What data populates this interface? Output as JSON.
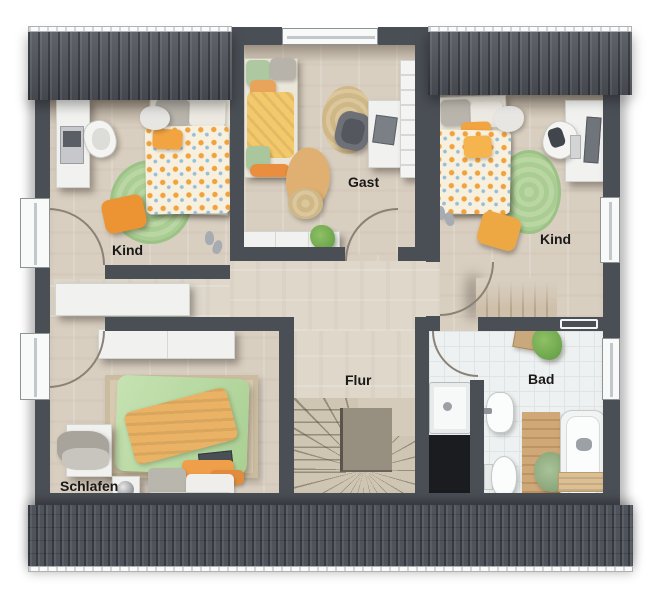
{
  "rooms": [
    {
      "id": "kind-left",
      "label": "Kind",
      "furniture": [
        "bed",
        "desk",
        "printer",
        "office-chair",
        "round-rug",
        "floor-cushion",
        "cloud-stool",
        "slippers",
        "window"
      ]
    },
    {
      "id": "gast",
      "label": "Gast",
      "furniture": [
        "daybed",
        "jute-rug",
        "armchair",
        "desk",
        "laptop",
        "wall-shelf",
        "sideboard",
        "plant",
        "throw-blanket",
        "pouf",
        "window"
      ]
    },
    {
      "id": "kind-right",
      "label": "Kind",
      "furniture": [
        "bed",
        "desk",
        "monitor",
        "office-chair",
        "round-rug",
        "floor-cushion",
        "cloud-stool",
        "slippers",
        "window"
      ]
    },
    {
      "id": "flur",
      "label": "Flur",
      "furniture": [
        "winder-staircase",
        "sideboard"
      ]
    },
    {
      "id": "bad",
      "label": "Bad",
      "furniture": [
        "shower",
        "washbasin",
        "toilet",
        "bathtub",
        "bath-caddy",
        "wooden-mat",
        "plant",
        "stool",
        "towel-radiator",
        "window"
      ]
    },
    {
      "id": "schlafen",
      "label": "Schlafen",
      "furniture": [
        "double-bed",
        "area-rug",
        "dresser",
        "clothes-pile",
        "nightstand",
        "table-lamp",
        "foot-bench",
        "sideboard",
        "window"
      ]
    }
  ],
  "colors": {
    "wall": "#4a4e55",
    "roof": "#4f535b",
    "floor_wood": "#d9cfc1",
    "floor_hall": "#ded7ca",
    "floor_tile": "#eef1f1",
    "rug_green": "#aecd97",
    "rug_jute": "#d5bf93",
    "duvet_orange": "#f0a23c",
    "duvet_green": "#bedcab",
    "blanket_orange": "#e9b264",
    "label_text": "#191919"
  }
}
